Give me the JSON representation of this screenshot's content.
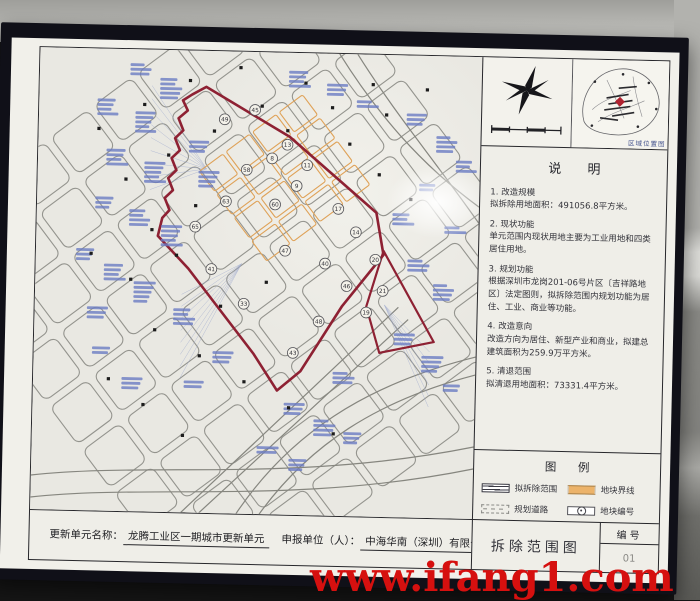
{
  "watermark": "www.ifang1.com",
  "location_map": {
    "caption": "区域位置图"
  },
  "notes": {
    "title": "说  明",
    "items": [
      {
        "heading": "1. 改造规模",
        "body": "拟拆除用地面积：491056.8平方米。"
      },
      {
        "heading": "2. 现状功能",
        "body": "单元范围内现状用地主要为工业用地和四类居住用地。"
      },
      {
        "heading": "3. 规划功能",
        "body": "根据深圳市龙岗201-06号片区〔吉祥路地区〕法定图则，拟拆除范围内规划功能为居住、工业、商业等功能。"
      },
      {
        "heading": "4. 改造意向",
        "body": "改造方向为居住、新型产业和商业，拟建总建筑面积为259.9万平方米。"
      },
      {
        "heading": "5. 清退范围",
        "body": "拟清退用地面积：73331.4平方米。"
      }
    ]
  },
  "legend": {
    "title": "图  例",
    "items": [
      {
        "label": "拟拆除范围",
        "symbol": "demolish-boundary"
      },
      {
        "label": "地块界线",
        "symbol": "parcel-line"
      },
      {
        "label": "规划道路",
        "symbol": "planned-road"
      },
      {
        "label": "地块编号",
        "symbol": "parcel-number"
      }
    ]
  },
  "title_bar": {
    "unit_name_label": "更新单元名称：",
    "unit_name": "龙腾工业区一期城市更新单元",
    "applicant_label": "申报单位（人）：",
    "applicant": "中海华南（深圳）有限公司"
  },
  "sheet": {
    "map_title": "拆除范围图",
    "number_label": "编号",
    "number": "01"
  },
  "map": {
    "background": "#e9e8e2",
    "boundary_color": "#8e2133",
    "parcel_line_color": "#dfa258",
    "street_color": "#94948e",
    "annotation_color": "#6b7cc4",
    "parcel_numbers": [
      {
        "n": "49",
        "x": 185,
        "y": 68
      },
      {
        "n": "45",
        "x": 215,
        "y": 58
      },
      {
        "n": "13",
        "x": 248,
        "y": 92
      },
      {
        "n": "11",
        "x": 268,
        "y": 112
      },
      {
        "n": "58",
        "x": 208,
        "y": 118
      },
      {
        "n": "8",
        "x": 233,
        "y": 106
      },
      {
        "n": "17",
        "x": 300,
        "y": 155
      },
      {
        "n": "14",
        "x": 318,
        "y": 178
      },
      {
        "n": "63",
        "x": 188,
        "y": 150
      },
      {
        "n": "60",
        "x": 237,
        "y": 152
      },
      {
        "n": "9",
        "x": 258,
        "y": 133
      },
      {
        "n": "20",
        "x": 338,
        "y": 205
      },
      {
        "n": "21",
        "x": 346,
        "y": 236
      },
      {
        "n": "19",
        "x": 330,
        "y": 258
      },
      {
        "n": "65",
        "x": 158,
        "y": 176
      },
      {
        "n": "41",
        "x": 175,
        "y": 218
      },
      {
        "n": "47",
        "x": 248,
        "y": 198
      },
      {
        "n": "40",
        "x": 288,
        "y": 210
      },
      {
        "n": "46",
        "x": 310,
        "y": 232
      },
      {
        "n": "48",
        "x": 283,
        "y": 268
      },
      {
        "n": "33",
        "x": 208,
        "y": 252
      },
      {
        "n": "43",
        "x": 258,
        "y": 300
      }
    ],
    "annotation_stacks": [
      [
        90,
        14,
        3
      ],
      [
        120,
        28,
        5
      ],
      [
        58,
        50,
        4
      ],
      [
        96,
        62,
        5
      ],
      [
        68,
        100,
        4
      ],
      [
        106,
        112,
        5
      ],
      [
        58,
        148,
        3
      ],
      [
        92,
        160,
        4
      ],
      [
        124,
        175,
        5
      ],
      [
        40,
        200,
        3
      ],
      [
        68,
        215,
        4
      ],
      [
        98,
        232,
        5
      ],
      [
        52,
        258,
        3
      ],
      [
        248,
        18,
        4
      ],
      [
        286,
        30,
        3
      ],
      [
        316,
        46,
        2
      ],
      [
        366,
        58,
        3
      ],
      [
        396,
        80,
        4
      ],
      [
        416,
        104,
        3
      ],
      [
        380,
        128,
        2
      ],
      [
        150,
        90,
        3
      ],
      [
        160,
        120,
        4
      ],
      [
        354,
        158,
        3
      ],
      [
        406,
        170,
        2
      ],
      [
        370,
        204,
        3
      ],
      [
        396,
        228,
        4
      ],
      [
        358,
        278,
        3
      ],
      [
        386,
        300,
        4
      ],
      [
        250,
        350,
        3
      ],
      [
        280,
        366,
        4
      ],
      [
        310,
        378,
        3
      ],
      [
        224,
        394,
        2
      ],
      [
        256,
        406,
        3
      ],
      [
        178,
        300,
        3
      ],
      [
        138,
        258,
        4
      ],
      [
        298,
        318,
        3
      ],
      [
        408,
        328,
        2
      ],
      [
        58,
        298,
        2
      ],
      [
        88,
        328,
        3
      ],
      [
        150,
        330,
        2
      ]
    ],
    "intersection_marks": [
      [
        60,
        80
      ],
      [
        105,
        55
      ],
      [
        150,
        30
      ],
      [
        200,
        16
      ],
      [
        88,
        130
      ],
      [
        130,
        105
      ],
      [
        175,
        80
      ],
      [
        222,
        54
      ],
      [
        265,
        30
      ],
      [
        115,
        180
      ],
      [
        158,
        155
      ],
      [
        248,
        78
      ],
      [
        292,
        54
      ],
      [
        332,
        30
      ],
      [
        95,
        230
      ],
      [
        140,
        205
      ],
      [
        55,
        205
      ],
      [
        185,
        255
      ],
      [
        230,
        230
      ],
      [
        310,
        90
      ],
      [
        346,
        60
      ],
      [
        386,
        34
      ],
      [
        120,
        280
      ],
      [
        165,
        305
      ],
      [
        210,
        330
      ],
      [
        255,
        355
      ],
      [
        300,
        380
      ],
      [
        75,
        330
      ],
      [
        110,
        355
      ],
      [
        150,
        385
      ],
      [
        340,
        120
      ],
      [
        372,
        144
      ]
    ]
  }
}
